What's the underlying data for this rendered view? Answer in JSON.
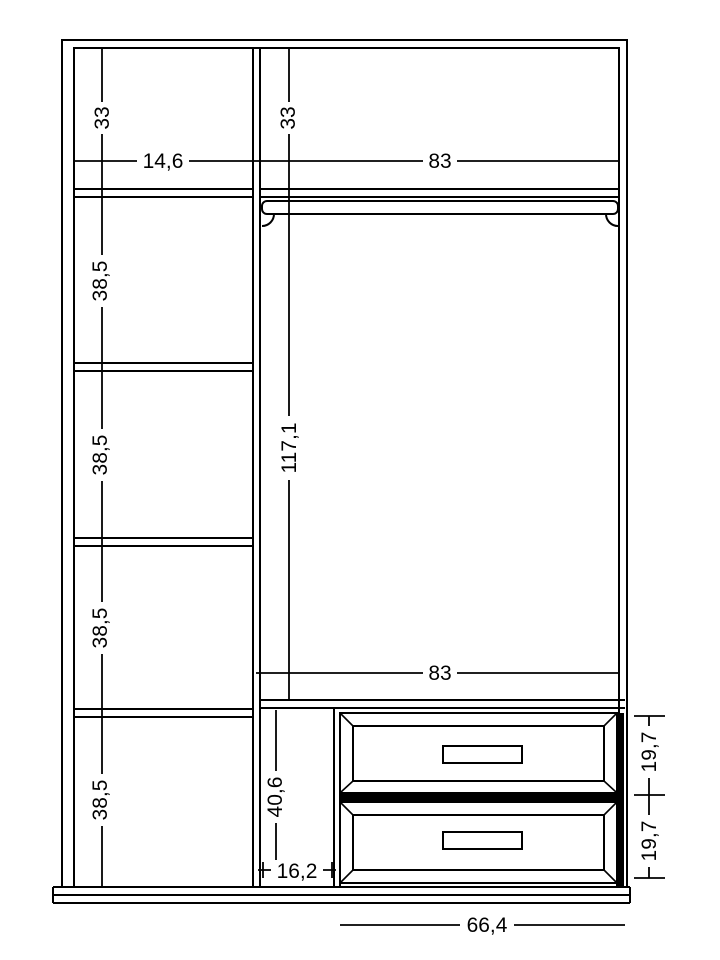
{
  "drawing": {
    "kind": "furniture-section-drawing",
    "units_style": "decimal-comma"
  },
  "dimensions": {
    "left_column": {
      "top_compartment_height": "33",
      "width": "14,6",
      "compartment_heights": [
        "38,5",
        "38,5",
        "38,5",
        "38,5"
      ]
    },
    "right_section": {
      "top_compartment_height": "33",
      "top_width": "83",
      "hanging_space_height": "117,1",
      "bottom_width": "83",
      "side_slot_height": "40,6",
      "side_slot_width": "16,2",
      "drawer_front_heights": [
        "19,7",
        "19,7"
      ],
      "drawer_unit_width": "66,4"
    }
  },
  "colors": {
    "line": "#000000",
    "background": "#ffffff",
    "drawer_gap_fill": "#000000"
  }
}
